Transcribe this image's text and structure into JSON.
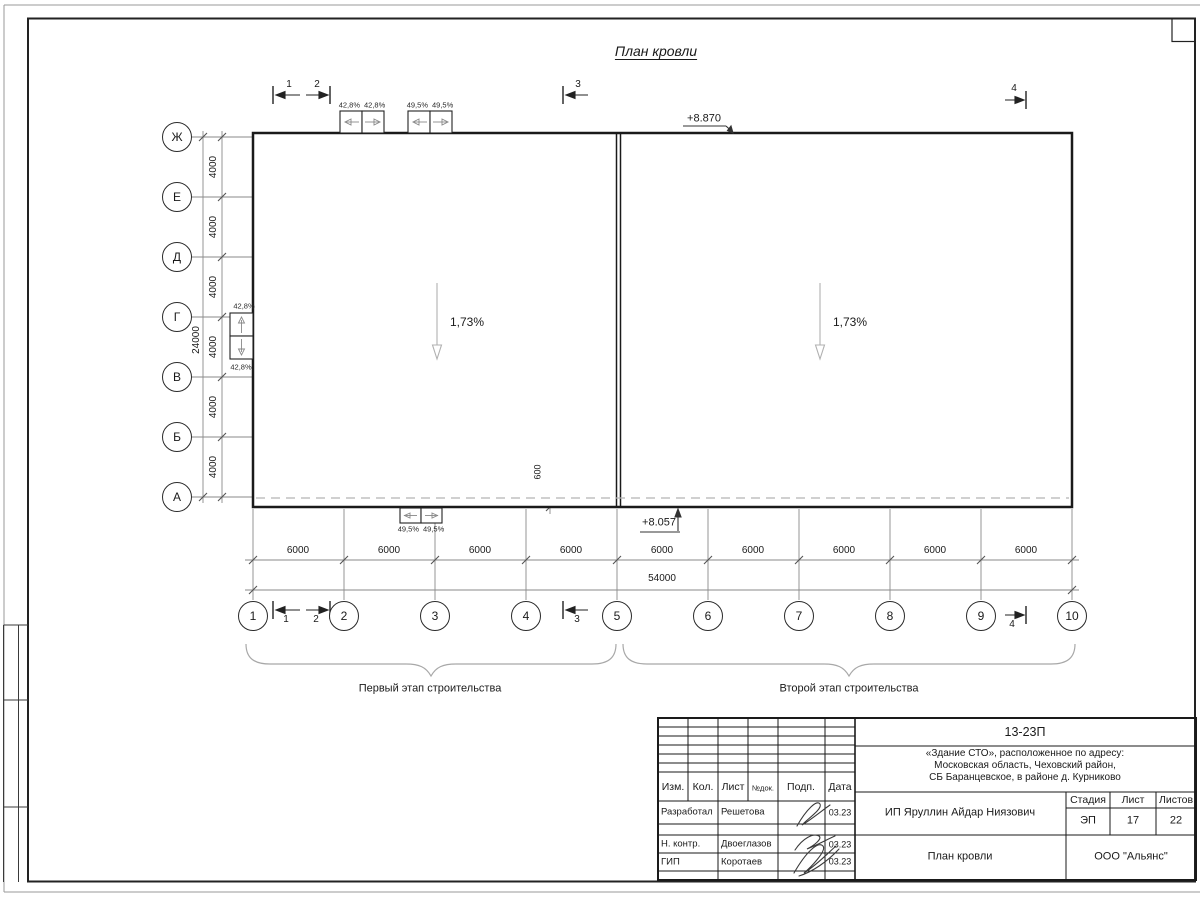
{
  "page": {
    "title": "План кровли"
  },
  "axes": {
    "rows": [
      "Ж",
      "Е",
      "Д",
      "Г",
      "В",
      "Б",
      "А"
    ],
    "cols": [
      "1",
      "2",
      "3",
      "4",
      "5",
      "6",
      "7",
      "8",
      "9",
      "10"
    ]
  },
  "dims": {
    "row_bays": [
      "4000",
      "4000",
      "4000",
      "4000",
      "4000",
      "4000"
    ],
    "row_total": "24000",
    "col_bays": [
      "6000",
      "6000",
      "6000",
      "6000",
      "6000",
      "6000",
      "6000",
      "6000",
      "6000"
    ],
    "col_total": "54000",
    "overhang": "600"
  },
  "marks": {
    "sections": [
      "1",
      "2",
      "3",
      "4"
    ],
    "elev_top": "+8.870",
    "elev_bottom": "+8.057",
    "slope_left": "1,73%",
    "slope_right": "1,73%"
  },
  "vents": {
    "top_a": [
      "42,8%",
      "42,8%"
    ],
    "top_b": [
      "49,5%",
      "49,5%"
    ],
    "left": [
      "42,8%",
      "42,8%"
    ],
    "bottom": [
      "49,5%",
      "49,5%"
    ]
  },
  "stages": {
    "first": "Первый этап строительства",
    "second": "Второй этап строительства"
  },
  "titleblock": {
    "doc_number": "13-23П",
    "project_line1": "«Здание СТО», расположенное по адресу:",
    "project_line2": "Московская область, Чеховский район,",
    "project_line3": "СБ Баранцевское, в районе д. Курниково",
    "cols": [
      "Изм.",
      "Кол.",
      "Лист",
      "№док.",
      "Подп.",
      "Дата"
    ],
    "people": [
      {
        "role": "Разработал",
        "name": "Решетова",
        "date": "03.23"
      },
      {
        "role": "Н. контр.",
        "name": "Двоеглазов",
        "date": "03.23"
      },
      {
        "role": "ГИП",
        "name": "Коротаев",
        "date": "03.23"
      }
    ],
    "client": "ИП Яруллин Айдар Ниязович",
    "stage_label": "Стадия",
    "sheet_label": "Лист",
    "sheets_label": "Листов",
    "stage": "ЭП",
    "sheet_no": "17",
    "sheets_total": "22",
    "drawing_title": "План кровли",
    "company": "ООО \"Альянс\""
  }
}
